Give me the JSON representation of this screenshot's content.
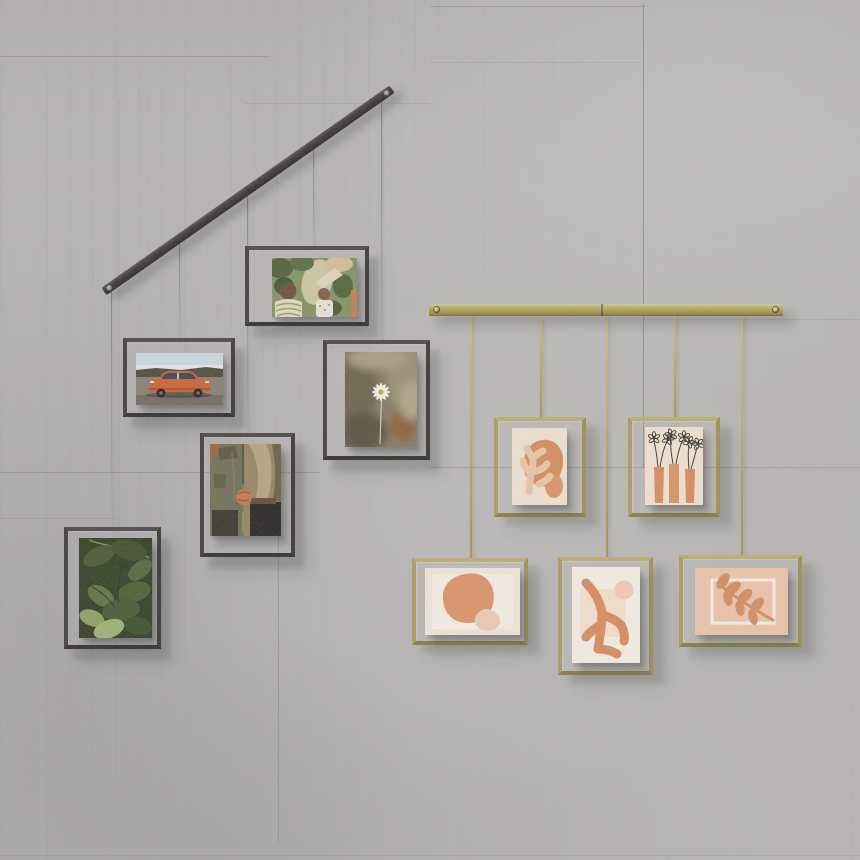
{
  "scene": {
    "title": "Hanging photo display systems on a concrete wall",
    "wall": {
      "material": "poured concrete with form seams",
      "seam_count": 12
    },
    "left_display": {
      "name": "black diagonal picture-hanging rail with five floating frames",
      "rail_color": "#312e2b",
      "wire_color": "#9a9894",
      "frame_count": 5,
      "frames": [
        {
          "id": "kids-garden-photo",
          "description": "Landscape photo: adult reaching toward two small children among green garden foliage",
          "orientation": "landscape"
        },
        {
          "id": "orange-car-photo",
          "description": "Landscape photo: vintage orange sedan parked on gravel under a pale sky",
          "orientation": "landscape"
        },
        {
          "id": "daisy-photo",
          "description": "Portrait photo: single white daisy against blurred dry grass",
          "orientation": "portrait"
        },
        {
          "id": "holding-hands-photo",
          "description": "Portrait photo: couple in olive and bronze jackets holding hands",
          "orientation": "portrait"
        },
        {
          "id": "green-leaves-photo",
          "description": "Portrait photo: close-up of dark green leaves",
          "orientation": "portrait"
        }
      ]
    },
    "right_display": {
      "name": "brass horizontal picture-hanging rail with five floating frames",
      "rail_color": "#a89a55",
      "wire_color": "#b1a35f",
      "frame_count": 5,
      "frames": [
        {
          "id": "coral-abstract-print",
          "description": "Portrait print: peach coral silhouette over a terracotta blob on cream",
          "orientation": "portrait"
        },
        {
          "id": "vases-flowers-print",
          "description": "Portrait print: three terracotta vases with black sketched daisies on cream",
          "orientation": "portrait"
        },
        {
          "id": "blob-abstract-print",
          "description": "Landscape print: large terracotta egg shape with small blush blob on cream",
          "orientation": "landscape"
        },
        {
          "id": "coral-branch-print",
          "description": "Portrait print: terracotta coral branch with blush circle on off-white",
          "orientation": "portrait"
        },
        {
          "id": "leaf-branch-print",
          "description": "Landscape print: terracotta leaf branch over a white outlined rectangle on blush pink",
          "orientation": "landscape"
        }
      ]
    }
  },
  "palette": {
    "wall-base": "#b7b6b4",
    "seam": "#64625c",
    "black-rail": "#312e2b",
    "black-frame": "#3b3834",
    "gold-frame": "#a89d58",
    "brass": "#b5a75f",
    "wire-silver": "#9a9894",
    "wire-gold": "#b1a35f",
    "cream": "#f3e4d2",
    "cream-2": "#f8f1e6",
    "terracotta": "#d98a5c",
    "terracotta-2": "#de9265",
    "peach": "#edc8a6",
    "blush": "#f3cdb4",
    "pink-bg": "#f0c4aa",
    "ink": "#37322b",
    "green-dark": "#2c381e",
    "green-mid": "#7f9160",
    "sage": "#9db173",
    "sky": "#ccdbe2",
    "car-orange": "#cd5f30",
    "hill": "#4d4537",
    "ground": "#837c6f",
    "jacket-olive": "#6e6c51",
    "jacket-tan": "#93835f",
    "skin": "#c5764e",
    "grass": "#6d7c43",
    "hair-brown": "#6b4c35",
    "hair-blonde": "#d6c093",
    "daisy-bg": "#847760",
    "white": "#f5f3ec"
  }
}
